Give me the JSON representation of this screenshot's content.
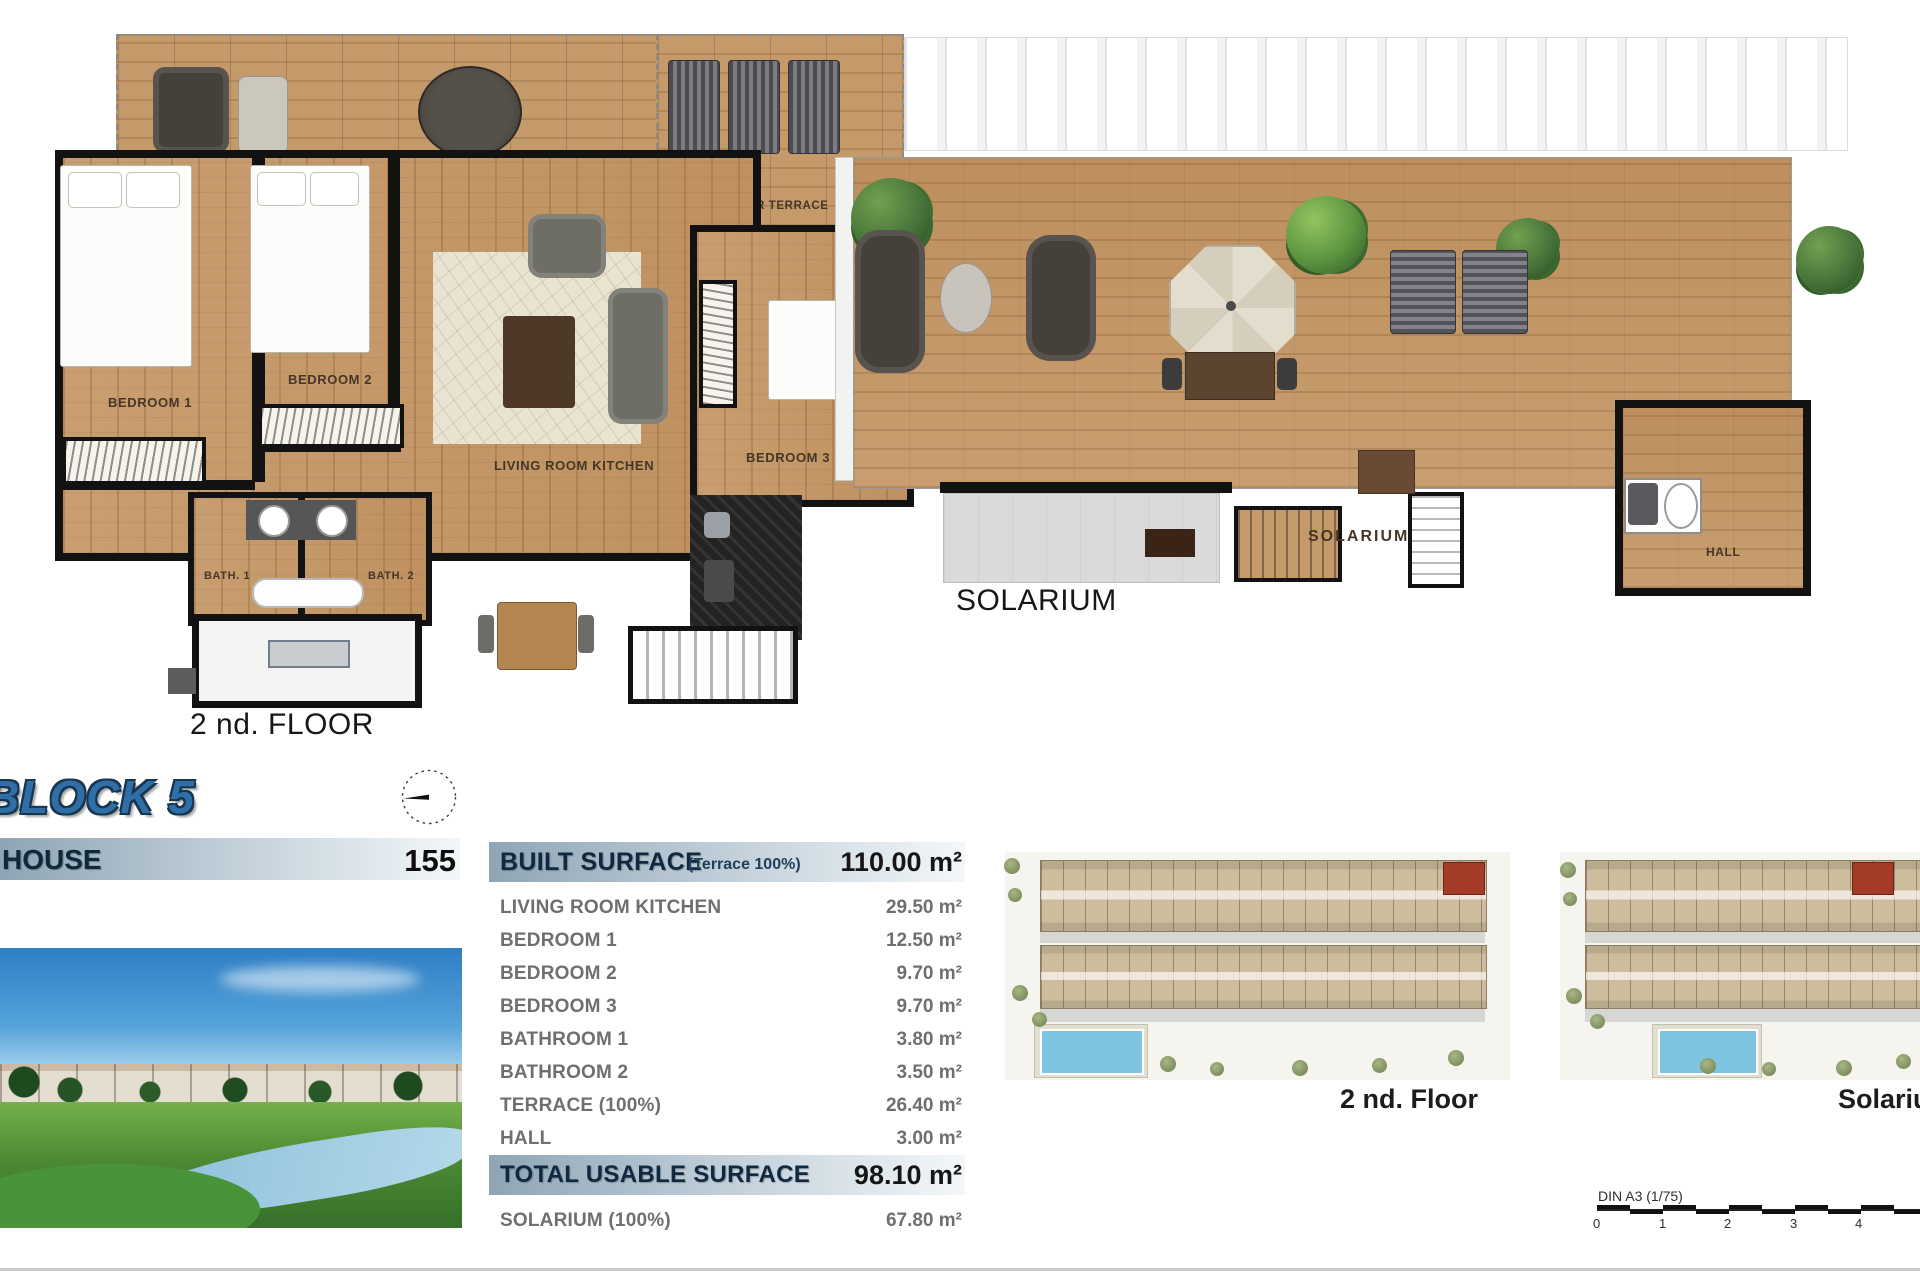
{
  "block_title": "BLOCK 5",
  "house_bar": {
    "label": "HOUSE",
    "number": "155"
  },
  "floor_plan": {
    "caption": "2 nd. FLOOR",
    "labels": {
      "outdoor_terrace": "OUTDOOR TERRACE",
      "bedroom1": "BEDROOM 1",
      "bedroom2": "BEDROOM 2",
      "bedroom3": "BEDROOM 3",
      "living": "LIVING ROOM KITCHEN",
      "bath1": "BATH. 1",
      "bath2": "BATH. 2"
    }
  },
  "solarium_plan": {
    "caption": "SOLARIUM",
    "labels": {
      "solarium": "SOLARIUM",
      "hall": "HALL"
    }
  },
  "surface_table": {
    "header": {
      "label": "BUILT SURFACE",
      "note": "(Terrace 100%)",
      "value": "110.00 m²"
    },
    "rows": [
      {
        "label": "LIVING ROOM KITCHEN",
        "value": "29.50 m²"
      },
      {
        "label": "BEDROOM 1",
        "value": "12.50 m²"
      },
      {
        "label": "BEDROOM 2",
        "value": "9.70 m²"
      },
      {
        "label": "BEDROOM 3",
        "value": "9.70 m²"
      },
      {
        "label": "BATHROOM 1",
        "value": "3.80 m²"
      },
      {
        "label": "BATHROOM 2",
        "value": "3.50 m²"
      },
      {
        "label": "TERRACE (100%)",
        "value": "26.40 m²"
      },
      {
        "label": "HALL",
        "value": "3.00 m²"
      }
    ],
    "total": {
      "label": "TOTAL USABLE SURFACE",
      "value": "98.10 m²"
    },
    "solarium_row": {
      "label": "SOLARIUM (100%)",
      "value": "67.80 m²"
    }
  },
  "site_plans": {
    "floor_caption": "2 nd. Floor",
    "solarium_caption": "Solarium"
  },
  "scale_bar": {
    "label": "DIN A3 (1/75)",
    "ticks": [
      "0",
      "1",
      "2",
      "3",
      "4"
    ]
  },
  "colors": {
    "accent_blue": "#2f6ea6",
    "header_bar_gradient_start": "#8fa5b5",
    "header_bar_gradient_end": "#f3f7f9",
    "wall_black": "#121212",
    "wood_floor": "#c69c6f",
    "highlight_unit_red": "#a33b28",
    "pool_blue": "#7cc4e0"
  }
}
